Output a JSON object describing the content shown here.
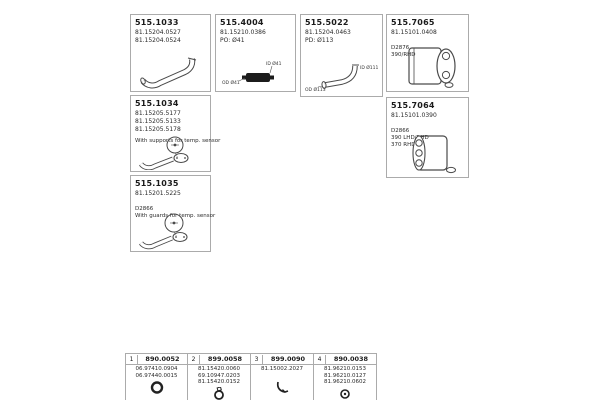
{
  "products": [
    {
      "id": "515.1033",
      "refs": [
        "81.15204.0527",
        "81.15204.0524"
      ]
    },
    {
      "id": "515.4004",
      "refs": [
        "81.15210.0386"
      ],
      "notes": [
        "PO: Ø41"
      ],
      "dims": {
        "top": "ID Ø41",
        "bottom": "OD Ø41"
      }
    },
    {
      "id": "515.5022",
      "refs": [
        "81.15204.0463"
      ],
      "notes": [
        "PD: Ø113"
      ],
      "dims": {
        "right": "ID Ø111",
        "bottom": "OD Ø113"
      }
    },
    {
      "id": "515.7065",
      "refs": [
        "81.15101.0408"
      ],
      "notes": [
        "D2876",
        "390/RHD"
      ]
    },
    {
      "id": "515.1034",
      "refs": [
        "81.15205.5177",
        "81.15205.5133",
        "81.15205.5178"
      ],
      "notes": [
        "With supports for temp. sensor"
      ]
    },
    {
      "id": "515.7064",
      "refs": [
        "81.15101.0390"
      ],
      "notes": [
        "D2866",
        "390 LHD/RHD",
        "370 RHD"
      ]
    },
    {
      "id": "515.1035",
      "refs": [
        "81.15201.5225"
      ],
      "notes": [
        "D2866",
        "With guards for temp. sensor"
      ]
    }
  ],
  "accessories": [
    {
      "num": "1",
      "code": "890.0052",
      "refs": [
        "06.97410.0904",
        "06.97440.0015"
      ]
    },
    {
      "num": "2",
      "code": "899.0058",
      "refs": [
        "81.15420.0060",
        "69.10947.0203",
        "81.15420.0152"
      ]
    },
    {
      "num": "3",
      "code": "899.0090",
      "refs": [
        "81.15002.2027"
      ]
    },
    {
      "num": "4",
      "code": "890.0038",
      "refs": [
        "81.96210.0153",
        "81.96210.0127",
        "81.96210.0602"
      ]
    }
  ]
}
